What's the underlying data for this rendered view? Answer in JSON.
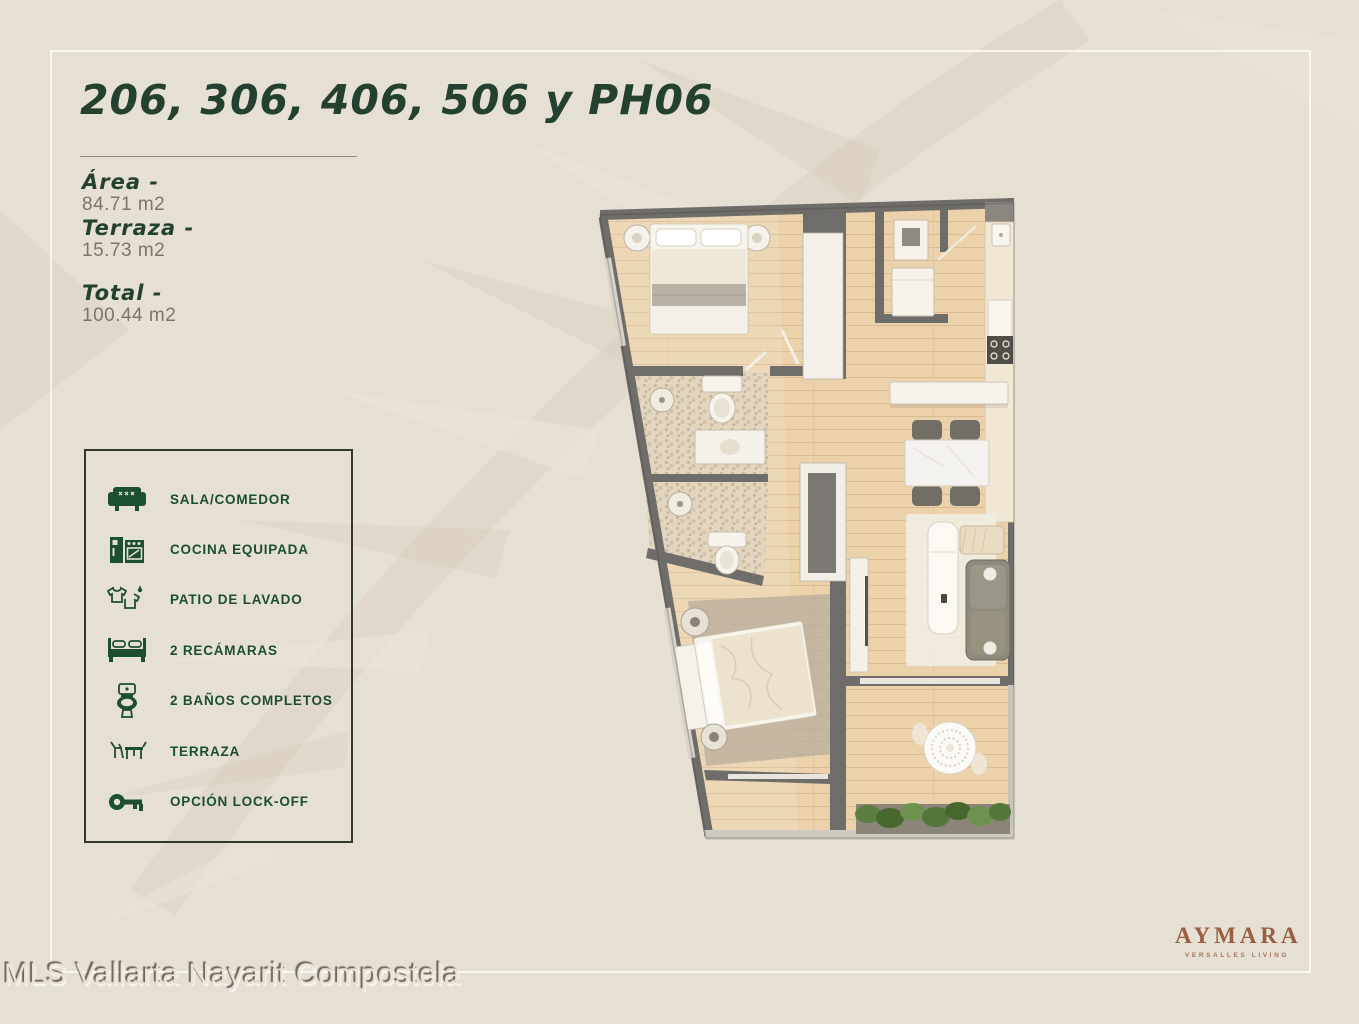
{
  "title": "206, 306, 406, 506 y PH06",
  "stats": {
    "area": {
      "label": "Área -",
      "value": "84.71 m2"
    },
    "terraza": {
      "label": "Terraza -",
      "value": "15.73 m2"
    },
    "total": {
      "label": "Total -",
      "value": "100.44 m2"
    }
  },
  "features": {
    "items": [
      {
        "icon": "sofa-icon",
        "label": "SALA/COMEDOR"
      },
      {
        "icon": "kitchen-icon",
        "label": "COCINA EQUIPADA"
      },
      {
        "icon": "laundry-icon",
        "label": "PATIO DE LAVADO"
      },
      {
        "icon": "bed-icon",
        "label": "2 RECÁMARAS"
      },
      {
        "icon": "toilet-icon",
        "label": "2 BAÑOS COMPLETOS"
      },
      {
        "icon": "terrace-icon",
        "label": "TERRAZA"
      },
      {
        "icon": "key-icon",
        "label": "OPCIÓN LOCK-OFF"
      }
    ]
  },
  "brand": {
    "name": "AYMARA",
    "tagline": "VERSALLES LIVING",
    "color": "#9a5e41"
  },
  "watermark": "MLS Vallarta Nayarit Compostela",
  "colors": {
    "background": "#e6dfd4",
    "title_green": "#24402f",
    "accent_green": "#1c4f2d",
    "value_gray": "#7c7668",
    "frame_line": "#faf7f0",
    "wall_gray": "#6f6d6a",
    "wood_floor": "#ebd2aa"
  }
}
